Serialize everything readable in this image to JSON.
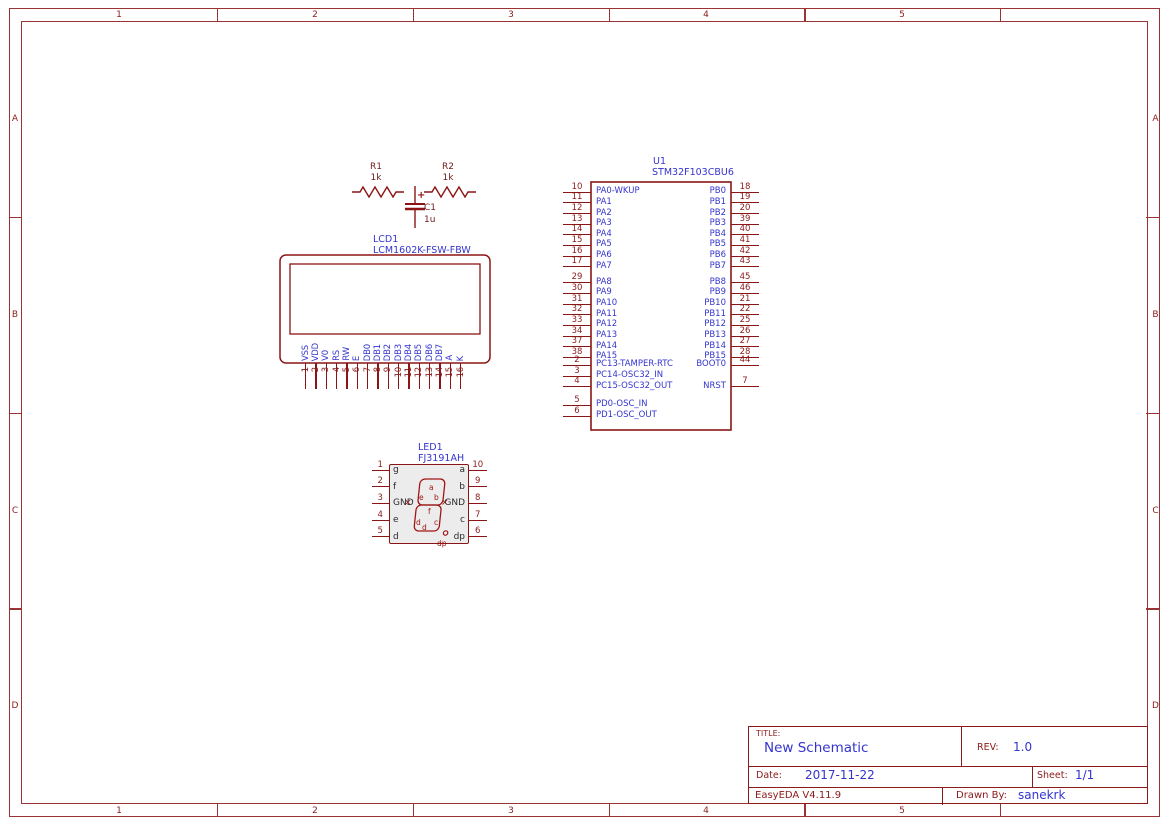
{
  "frame": {
    "columns": [
      "1",
      "2",
      "3",
      "4",
      "5"
    ],
    "rows": [
      "A",
      "B",
      "C",
      "D"
    ]
  },
  "components": {
    "r1": {
      "ref": "R1",
      "value": "1k"
    },
    "r2": {
      "ref": "R2",
      "value": "1k"
    },
    "c1": {
      "ref": "C1",
      "value": "1u",
      "polarity": "+"
    },
    "u1": {
      "ref": "U1",
      "part": "STM32F103CBU6",
      "pins_pa0_7": [
        {
          "num": "10",
          "name": "PA0-WKUP"
        },
        {
          "num": "11",
          "name": "PA1"
        },
        {
          "num": "12",
          "name": "PA2"
        },
        {
          "num": "13",
          "name": "PA3"
        },
        {
          "num": "14",
          "name": "PA4"
        },
        {
          "num": "15",
          "name": "PA5"
        },
        {
          "num": "16",
          "name": "PA6"
        },
        {
          "num": "17",
          "name": "PA7"
        }
      ],
      "pins_pa8_15": [
        {
          "num": "29",
          "name": "PA8"
        },
        {
          "num": "30",
          "name": "PA9"
        },
        {
          "num": "31",
          "name": "PA10"
        },
        {
          "num": "32",
          "name": "PA11"
        },
        {
          "num": "33",
          "name": "PA12"
        },
        {
          "num": "34",
          "name": "PA13"
        },
        {
          "num": "37",
          "name": "PA14"
        },
        {
          "num": "38",
          "name": "PA15"
        }
      ],
      "pins_pc": [
        {
          "num": "2",
          "name": "PC13-TAMPER-RTC"
        },
        {
          "num": "3",
          "name": "PC14-OSC32_IN"
        },
        {
          "num": "4",
          "name": "PC15-OSC32_OUT"
        }
      ],
      "pins_pd": [
        {
          "num": "5",
          "name": "PD0-OSC_IN"
        },
        {
          "num": "6",
          "name": "PD1-OSC_OUT"
        }
      ],
      "pins_pb0_7": [
        {
          "num": "18",
          "name": "PB0"
        },
        {
          "num": "19",
          "name": "PB1"
        },
        {
          "num": "20",
          "name": "PB2"
        },
        {
          "num": "39",
          "name": "PB3"
        },
        {
          "num": "40",
          "name": "PB4"
        },
        {
          "num": "41",
          "name": "PB5"
        },
        {
          "num": "42",
          "name": "PB6"
        },
        {
          "num": "43",
          "name": "PB7"
        }
      ],
      "pins_pb8_15": [
        {
          "num": "45",
          "name": "PB8"
        },
        {
          "num": "46",
          "name": "PB9"
        },
        {
          "num": "21",
          "name": "PB10"
        },
        {
          "num": "22",
          "name": "PB11"
        },
        {
          "num": "25",
          "name": "PB12"
        },
        {
          "num": "26",
          "name": "PB13"
        },
        {
          "num": "27",
          "name": "PB14"
        },
        {
          "num": "28",
          "name": "PB15"
        }
      ],
      "pin_boot0": [
        {
          "num": "44",
          "name": "BOOT0"
        }
      ],
      "pin_nrst": [
        {
          "num": "7",
          "name": "NRST"
        }
      ]
    },
    "lcd1": {
      "ref": "LCD1",
      "part": "LCM1602K-FSW-FBW",
      "pins": [
        {
          "num": "1",
          "name": "VSS"
        },
        {
          "num": "2",
          "name": "VDD"
        },
        {
          "num": "3",
          "name": "V0"
        },
        {
          "num": "4",
          "name": "RS"
        },
        {
          "num": "5",
          "name": "RW"
        },
        {
          "num": "6",
          "name": "E"
        },
        {
          "num": "7",
          "name": "DB0"
        },
        {
          "num": "8",
          "name": "DB1"
        },
        {
          "num": "9",
          "name": "DB2"
        },
        {
          "num": "10",
          "name": "DB3"
        },
        {
          "num": "11",
          "name": "DB4"
        },
        {
          "num": "12",
          "name": "DB5"
        },
        {
          "num": "13",
          "name": "DB6"
        },
        {
          "num": "14",
          "name": "DB7"
        },
        {
          "num": "15",
          "name": "A"
        },
        {
          "num": "16",
          "name": "K"
        }
      ]
    },
    "led1": {
      "ref": "LED1",
      "part": "FJ3191AH",
      "left_pins": [
        {
          "num": "1",
          "name": "g"
        },
        {
          "num": "2",
          "name": "f"
        },
        {
          "num": "3",
          "name": "GND"
        },
        {
          "num": "4",
          "name": "e"
        },
        {
          "num": "5",
          "name": "d"
        }
      ],
      "right_pins": [
        {
          "num": "10",
          "name": "a"
        },
        {
          "num": "9",
          "name": "b"
        },
        {
          "num": "8",
          "name": "GND"
        },
        {
          "num": "7",
          "name": "c"
        },
        {
          "num": "6",
          "name": "dp"
        }
      ],
      "seg": {
        "a": "a",
        "b": "b",
        "c": "c",
        "d": "d",
        "d_small": "d",
        "e": "e",
        "f": "f",
        "dp": "dp"
      },
      "no_connect": "×"
    }
  },
  "title_block": {
    "title_label": "TITLE:",
    "title": "New Schematic",
    "rev_label": "REV:",
    "rev": "1.0",
    "date_label": "Date:",
    "date": "2017-11-22",
    "sheet_label": "Sheet:",
    "sheet": "1/1",
    "tool_version": "EasyEDA V4.11.9",
    "drawn_by_label": "Drawn By:",
    "drawn_by": "sanekrk"
  },
  "colors": {
    "frame": "#9a3434",
    "symbol_stroke": "#8b1515",
    "pin_name_blue": "#3434cf",
    "pin_number_red": "#8b1a1a",
    "value_text": "#702020",
    "led_fill": "#ececec"
  }
}
